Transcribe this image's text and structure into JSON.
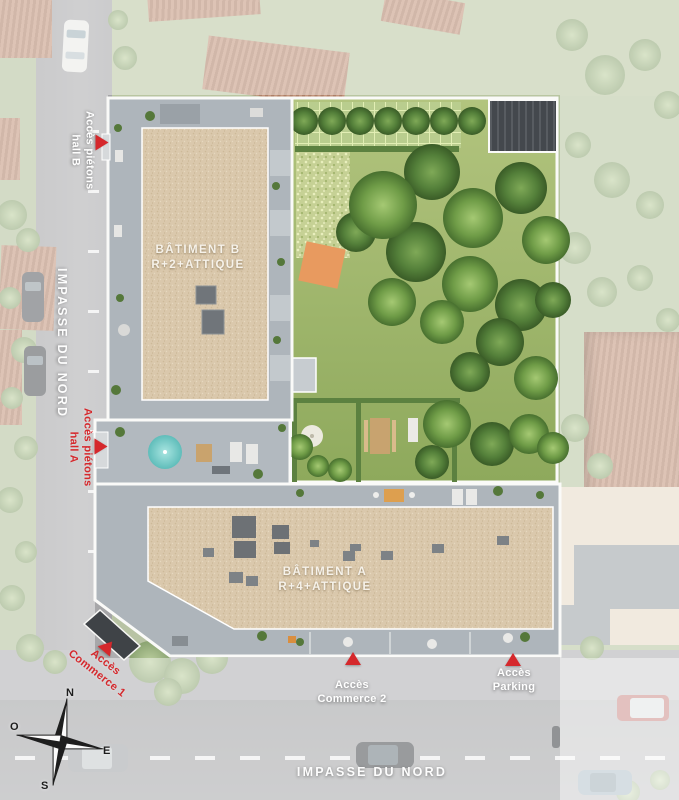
{
  "plan": {
    "title": "Plan de masse résidence",
    "streets": {
      "left": "IMPASSE DU NORD",
      "bottom": "IMPASSE DU NORD"
    },
    "buildings": {
      "b": {
        "name": "BÂTIMENT B",
        "floors": "R+2+ATTIQUE"
      },
      "a": {
        "name": "BÂTIMENT A",
        "floors": "R+4+ATTIQUE"
      }
    },
    "access_points": {
      "hall_b": {
        "line1": "Accès piétons",
        "line2": "hall B",
        "text_color": "#ffffff"
      },
      "hall_a": {
        "line1": "Accès piétons",
        "line2": "hall A",
        "text_color": "#d5282c"
      },
      "commerce_1": {
        "line1": "Accès",
        "line2": "Commerce 1",
        "text_color": "#d5282c"
      },
      "commerce_2": {
        "line1": "Accès",
        "line2": "Commerce 2",
        "text_color": "#ffffff"
      },
      "parking": {
        "line1": "Accès",
        "line2": "Parking",
        "text_color": "#ffffff"
      }
    },
    "compass": {
      "north": "N",
      "east": "E",
      "south": "S",
      "west": "O"
    },
    "colors": {
      "marker_red": "#d5282c",
      "roof_tan": "#dac8ac",
      "terrace_gray": "#aeb5bb",
      "lawn_green": "#9cb36b",
      "road_gray": "#a6a7a9",
      "neighbor_roof": "#bb8d72",
      "site_outline": "#fafaf8"
    }
  }
}
